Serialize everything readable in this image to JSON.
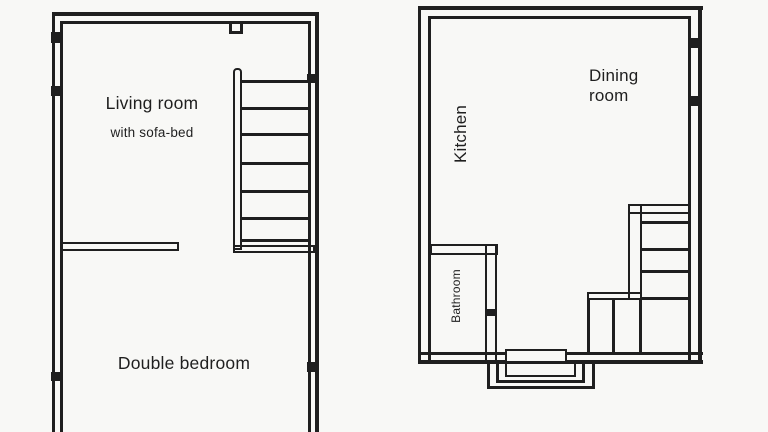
{
  "colors": {
    "background": "#f8f8f6",
    "ink": "#1f1f1f"
  },
  "plan_left": {
    "living_room": {
      "label": "Living room",
      "sublabel": "with sofa-bed"
    },
    "bedroom": {
      "label": "Double bedroom"
    }
  },
  "plan_right": {
    "kitchen": {
      "label": "Kitchen"
    },
    "dining_room": {
      "label": "Dining room"
    },
    "bathroom": {
      "label": "Bathroom"
    }
  }
}
